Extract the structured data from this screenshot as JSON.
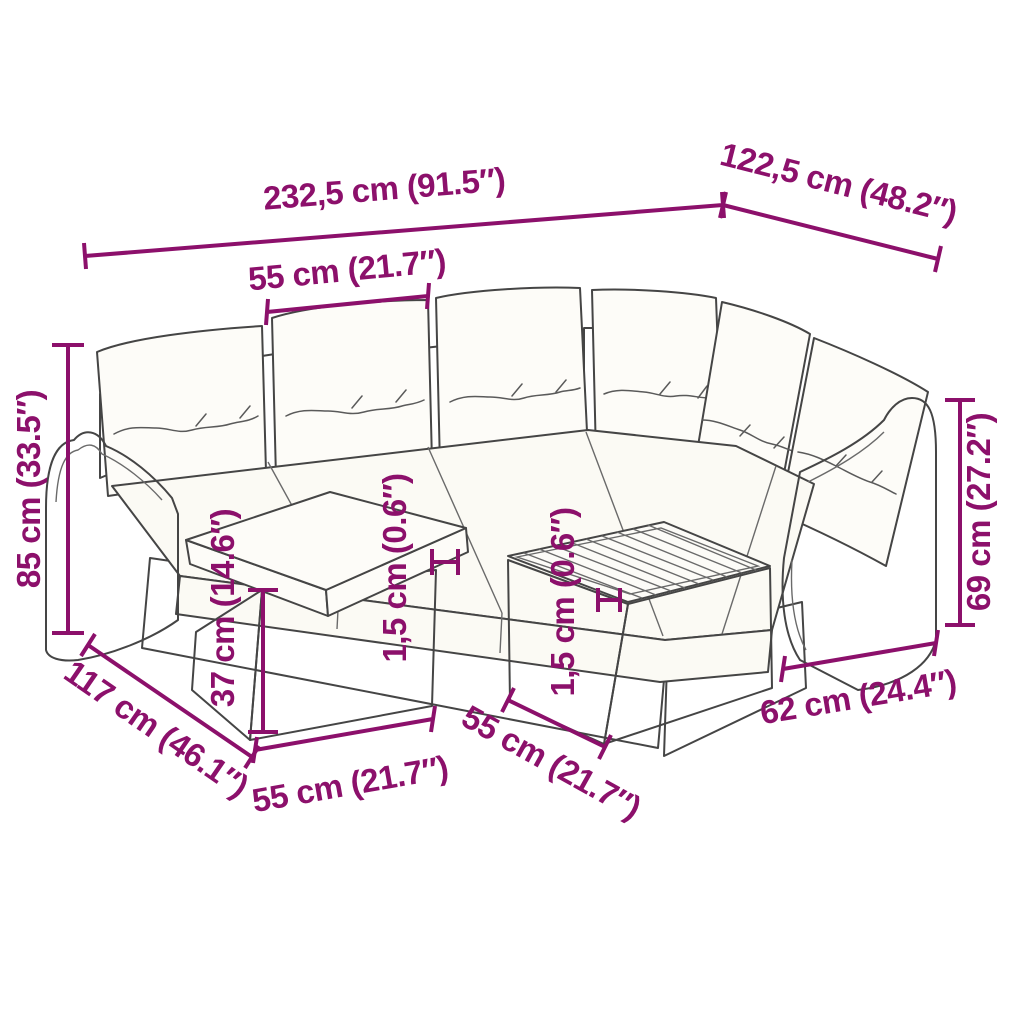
{
  "diagram": {
    "type": "product-dimension-diagram",
    "product": "7-piece poly rattan garden lounge set with cushions, footstool and table",
    "colors": {
      "dimension_accent": "#8C106B",
      "line_art": "#454545",
      "weave": "#8d8d8d",
      "cushion_fill": "#fdfcf8",
      "background": "#ffffff"
    }
  },
  "dims": {
    "overall_width": "232,5 cm (91.5″)",
    "overall_depth": "122,5 cm (48.2″)",
    "seat_width": "55 cm (21.7″)",
    "overall_height": "85 cm (33.5″)",
    "sofa_depth": "117 cm (46.1″)",
    "footstool_height": "37 cm (14.6″)",
    "footstool_width": "55 cm (21.7″)",
    "table_width": "55 cm (21.7″)",
    "table_depth": "62 cm (24.4″)",
    "armrest_height": "69 cm (27.2″)",
    "slat_thickness_sofa": "1,5 cm (0.6″)",
    "slat_thickness_table": "1,5 cm (0.6″)"
  }
}
